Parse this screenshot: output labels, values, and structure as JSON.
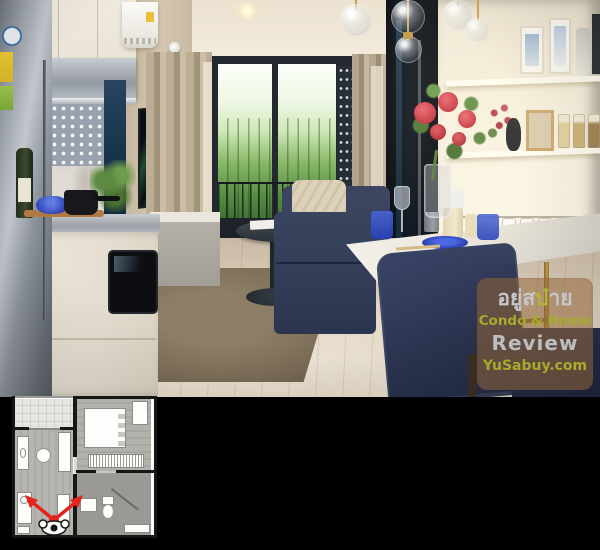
{
  "watermark": {
    "thai_pre": "อยู่ส",
    "thai_accent": "บ๋",
    "thai_post": "าย",
    "line2": "Condo & Home",
    "line3": "Review",
    "line4": "YuSabuy.com"
  },
  "colors": {
    "brand_yellow_green": "#a6aa2d",
    "watermark_gray": "#c6c7ca",
    "watermark_panel": "rgba(148,102,58,0.55)",
    "viewpoint_arrow_red": "#e3251c",
    "sofa_navy": "#333d58",
    "background": "#000000"
  }
}
